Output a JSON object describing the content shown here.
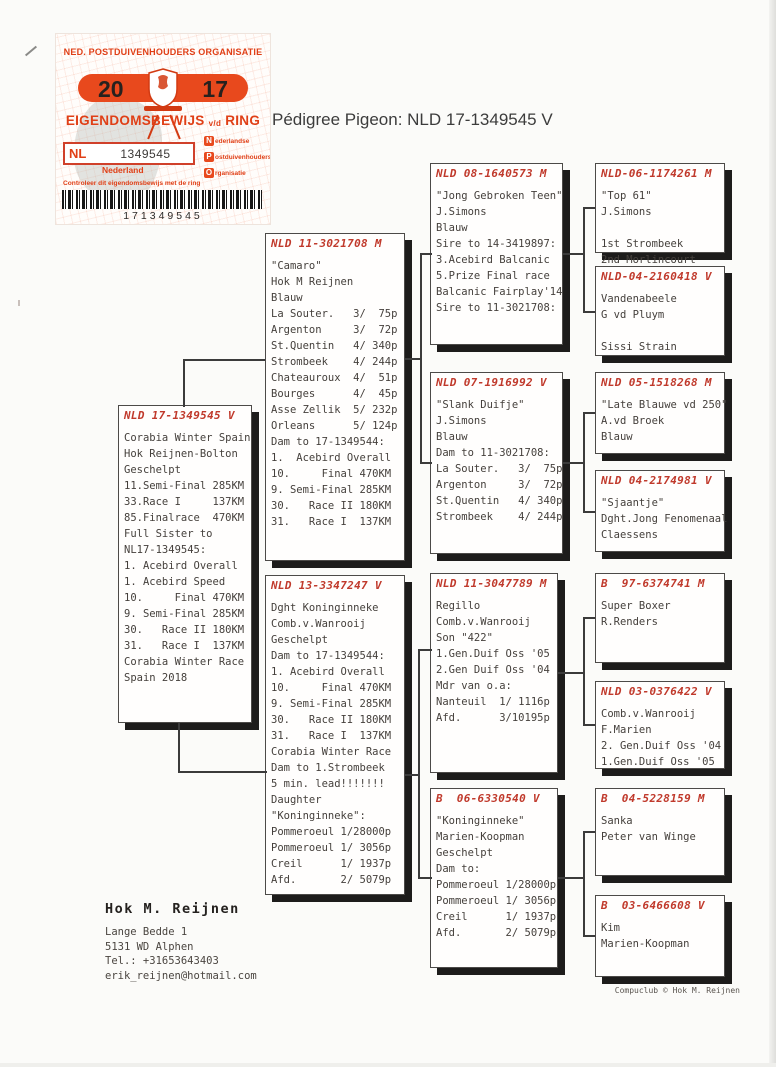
{
  "page": {
    "title": "Pédigree Pigeon: NLD 17-1349545 V",
    "credit": "Compuclub © Hok M. Reijnen"
  },
  "certificate": {
    "org": "NED. POSTDUIVENHOUDERS ORGANISATIE",
    "year_left": "20",
    "year_right": "17",
    "doc_main": "EIGENDOMSBEWIJS",
    "doc_small": "v/d",
    "doc_end": "RING",
    "country_code": "NL",
    "ring_number": "1349545",
    "country_name": "Nederland",
    "npo_rows": [
      {
        "letter": "N",
        "rest": "ederlandse"
      },
      {
        "letter": "P",
        "rest": "ostduivenhouders"
      },
      {
        "letter": "O",
        "rest": "rganisatie"
      }
    ],
    "note": "Controleer dit eigendomsbewijs met de ring",
    "barcode_number": "171349545",
    "accent_color": "#e03f16"
  },
  "owner": {
    "name": "Hok M. Reijnen",
    "address1": "Lange Bedde 1",
    "address2": "5131 WD  Alphen",
    "tel": "Tel.: +31653643403",
    "email": "erik_reijnen@hotmail.com"
  },
  "pedigree": {
    "boxes": [
      {
        "id": "subject",
        "ring": "NLD 17-1349545 V",
        "lines": [
          "Corabia Winter Spain",
          "Hok Reijnen-Bolton",
          "Geschelpt",
          "11.Semi-Final 285KM",
          "33.Race I     137KM",
          "85.Finalrace  470KM",
          "Full Sister to",
          "NL17-1349545:",
          "1. Acebird Overall",
          "1. Acebird Speed",
          "10.     Final 470KM",
          "9. Semi-Final 285KM",
          "30.   Race II 180KM",
          "31.   Race I  137KM",
          "Corabia Winter Race",
          "Spain 2018"
        ]
      },
      {
        "id": "sire",
        "ring": "NLD 11-3021708 M",
        "lines": [
          "\"Camaro\"",
          "Hok M Reijnen",
          "Blauw",
          "La Souter.   3/  75p",
          "Argenton     3/  72p",
          "St.Quentin   4/ 340p",
          "Strombeek    4/ 244p",
          "Chateauroux  4/  51p",
          "Bourges      4/  45p",
          "Asse Zellik  5/ 232p",
          "Orleans      5/ 124p",
          "Dam to 17-1349544:",
          "1.  Acebird Overall",
          "10.     Final 470KM",
          "9. Semi-Final 285KM",
          "30.   Race II 180KM",
          "31.   Race I  137KM"
        ]
      },
      {
        "id": "dam",
        "ring": "NLD 13-3347247 V",
        "lines": [
          "Dght Koninginneke",
          "Comb.v.Wanrooij",
          "Geschelpt",
          "Dam to 17-1349544:",
          "1. Acebird Overall",
          "10.     Final 470KM",
          "9. Semi-Final 285KM",
          "30.   Race II 180KM",
          "31.   Race I  137KM",
          "Corabia Winter Race",
          "Dam to 1.Strombeek",
          "5 min. lead!!!!!!!",
          "Daughter",
          "\"Koninginneke\":",
          "Pommeroeul 1/28000p",
          "Pommeroeul 1/ 3056p",
          "Creil      1/ 1937p",
          "Afd.       2/ 5079p"
        ]
      },
      {
        "id": "sire-sire",
        "ring": "NLD 08-1640573 M",
        "lines": [
          "\"Jong Gebroken Teen\"",
          "J.Simons",
          "Blauw",
          "Sire to 14-3419897:",
          "3.Acebird Balcanic",
          "5.Prize Final race",
          "Balcanic Fairplay'14",
          "Sire to 11-3021708:"
        ]
      },
      {
        "id": "sire-dam",
        "ring": "NLD 07-1916992 V",
        "lines": [
          "\"Slank Duifje\"",
          "J.Simons",
          "Blauw",
          "Dam to 11-3021708:",
          "La Souter.   3/  75p",
          "Argenton     3/  72p",
          "St.Quentin   4/ 340p",
          "Strombeek    4/ 244p"
        ]
      },
      {
        "id": "dam-sire",
        "ring": "NLD 11-3047789 M",
        "lines": [
          "Regillo",
          "Comb.v.Wanrooij",
          "Son \"422\"",
          "1.Gen.Duif Oss '05",
          "2.Gen Duif Oss '04",
          "Mdr van o.a:",
          "Nanteuil  1/ 1116p",
          "Afd.      3/10195p"
        ]
      },
      {
        "id": "dam-dam",
        "ring": "B  06-6330540 V",
        "lines": [
          "\"Koninginneke\"",
          "Marien-Koopman",
          "Geschelpt",
          "Dam to:",
          "Pommeroeul 1/28000p",
          "Pommeroeul 1/ 3056p",
          "Creil      1/ 1937p",
          "Afd.       2/ 5079p"
        ]
      },
      {
        "id": "ss-sire",
        "ring": "NLD-06-1174261 M",
        "lines": [
          "\"Top 61\"",
          "J.Simons",
          "",
          "1st Strombeek",
          "2nd Morlincourt"
        ]
      },
      {
        "id": "ss-dam",
        "ring": "NLD-04-2160418 V",
        "lines": [
          "Vandenabeele",
          "G vd Pluym",
          "",
          "Sissi Strain"
        ]
      },
      {
        "id": "sd-sire",
        "ring": "NLD 05-1518268 M",
        "lines": [
          "\"Late Blauwe vd 250\"",
          "A.vd Broek",
          "Blauw"
        ]
      },
      {
        "id": "sd-dam",
        "ring": "NLD 04-2174981 V",
        "lines": [
          "\"Sjaantje\"",
          "Dght.Jong Fenomenaal",
          "Claessens"
        ]
      },
      {
        "id": "ds-sire",
        "ring": "B  97-6374741 M",
        "lines": [
          "Super Boxer",
          "R.Renders"
        ]
      },
      {
        "id": "ds-dam",
        "ring": "NLD 03-0376422 V",
        "lines": [
          "Comb.v.Wanrooij",
          "F.Marien",
          "2. Gen.Duif Oss '04",
          "1.Gen.Duif Oss '05"
        ]
      },
      {
        "id": "dd-sire",
        "ring": "B  04-5228159 M",
        "lines": [
          "Sanka",
          "Peter van Winge"
        ]
      },
      {
        "id": "dd-dam",
        "ring": "B  03-6466608 V",
        "lines": [
          "Kim",
          "Marien-Koopman"
        ]
      }
    ]
  }
}
